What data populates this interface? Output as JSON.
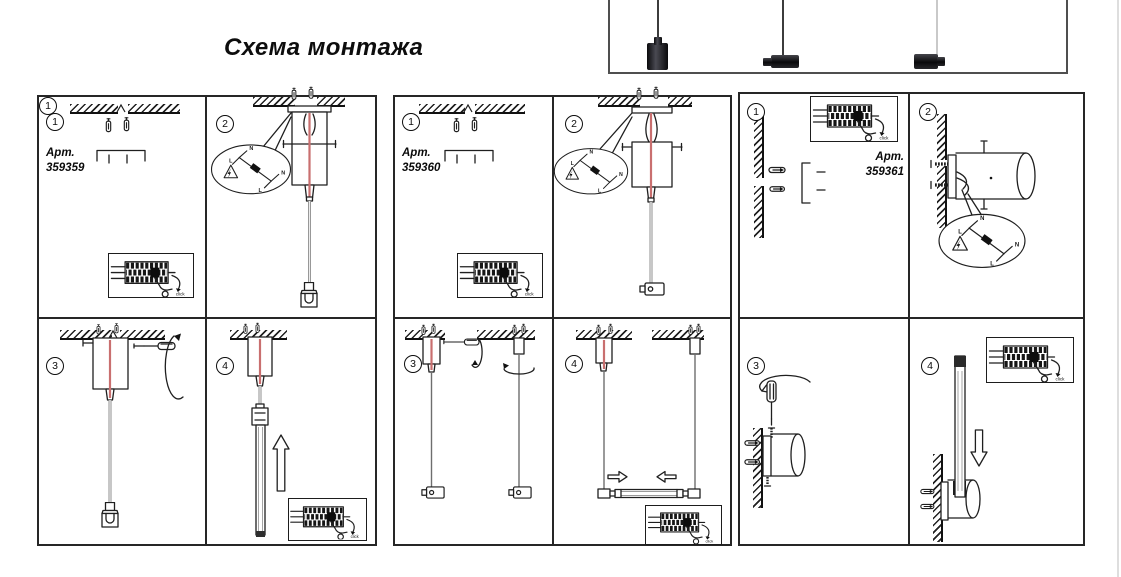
{
  "title": "Схема монтажа",
  "annotations": {
    "click": "click",
    "l": "L",
    "n": "N"
  },
  "panels": [
    {
      "article_label": "Арт.",
      "article_number": "359359",
      "steps": [
        "1",
        "2",
        "3",
        "4"
      ]
    },
    {
      "article_label": "Арт.",
      "article_number": "359360",
      "steps": [
        "1",
        "2",
        "3",
        "4"
      ]
    },
    {
      "article_label": "Арт.",
      "article_number": "359361",
      "steps": [
        "1",
        "2",
        "3",
        "4"
      ]
    }
  ],
  "preview": {
    "lamps": [
      "pendant-vertical-cylinder",
      "pendant-horizontal-left",
      "pendant-horizontal-right"
    ]
  },
  "colors": {
    "line": "#1f1f1f",
    "cable_red": "#c96f6f",
    "lamp_body": "#141414"
  }
}
